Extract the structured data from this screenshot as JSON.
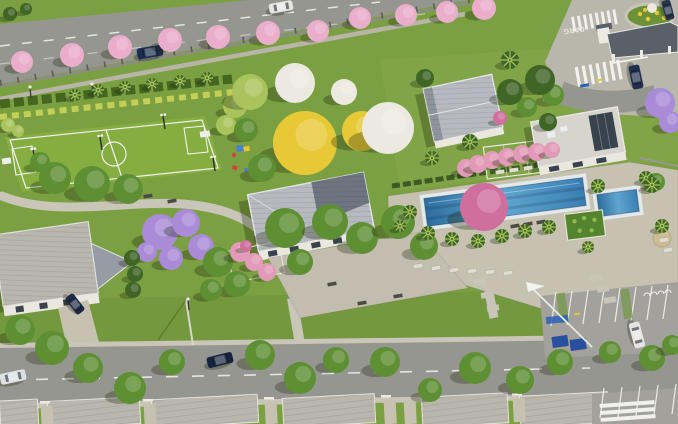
{
  "scene": {
    "description": "Aerial 3D architectural render of a gated residential community leisure area with soccer field, clubhouse, pool, playground, entrance gate and street of houses",
    "road_marking_text": "CARG",
    "palette": {
      "grass": "#7ba042",
      "grassDark": "#6c9136",
      "field": "#85ad3f",
      "asphalt": "#95968f",
      "paving": "#c6c1b0",
      "sidewalk": "#c9c5b8",
      "roofLight": "#b6bac0",
      "roofDark": "#6d7680",
      "roofHouse": "#b9b6ad",
      "wallWhite": "#eae7df",
      "water": "#3f7fae",
      "waterLight": "#6fb0d8",
      "coping": "#e3e8ea",
      "treeGreen": "#5f8f33",
      "treeDark": "#3f6527",
      "treeLight": "#a9c45c",
      "treePink": "#eaaecb",
      "treePurple": "#a98bd8",
      "treeYellow": "#e7c937",
      "treeWhite": "#ece9e0",
      "hedge": "#44661f",
      "shrubYellow": "#c3cf56",
      "flag": "#f2f2ef",
      "binBlue": "#2a4fa0",
      "pergolaPink": "#e29ab8",
      "bougainvillea": "#cf6f9e",
      "umbrellaTan": "#cdbd94",
      "flowersYellow": "#e4c93a",
      "shadow": "rgba(25,35,10,0.30)"
    },
    "trees": [
      {
        "x": 22,
        "y": 62,
        "r": 11,
        "t": "pink"
      },
      {
        "x": 72,
        "y": 55,
        "r": 12,
        "t": "pink"
      },
      {
        "x": 120,
        "y": 47,
        "r": 12,
        "t": "pink"
      },
      {
        "x": 170,
        "y": 40,
        "r": 12,
        "t": "pink"
      },
      {
        "x": 218,
        "y": 37,
        "r": 12,
        "t": "pink"
      },
      {
        "x": 268,
        "y": 33,
        "r": 12,
        "t": "pink"
      },
      {
        "x": 318,
        "y": 31,
        "r": 11,
        "t": "pink"
      },
      {
        "x": 360,
        "y": 18,
        "r": 11,
        "t": "pink"
      },
      {
        "x": 406,
        "y": 15,
        "r": 11,
        "t": "pink"
      },
      {
        "x": 447,
        "y": 12,
        "r": 11,
        "t": "pink"
      },
      {
        "x": 484,
        "y": 8,
        "r": 12,
        "t": "pink"
      },
      {
        "x": 160,
        "y": 232,
        "r": 18,
        "t": "purple"
      },
      {
        "x": 186,
        "y": 223,
        "r": 14,
        "t": "purple"
      },
      {
        "x": 201,
        "y": 247,
        "r": 13,
        "t": "purple"
      },
      {
        "x": 171,
        "y": 258,
        "r": 12,
        "t": "purple"
      },
      {
        "x": 147,
        "y": 252,
        "r": 10,
        "t": "purple"
      },
      {
        "x": 660,
        "y": 103,
        "r": 15,
        "t": "purple"
      },
      {
        "x": 670,
        "y": 122,
        "r": 11,
        "t": "purple"
      },
      {
        "x": 305,
        "y": 143,
        "r": 32,
        "t": "yellow"
      },
      {
        "x": 362,
        "y": 131,
        "r": 20,
        "t": "yellow"
      },
      {
        "x": 295,
        "y": 83,
        "r": 20,
        "t": "white"
      },
      {
        "x": 388,
        "y": 128,
        "r": 26,
        "t": "white"
      },
      {
        "x": 344,
        "y": 92,
        "r": 13,
        "t": "white"
      },
      {
        "x": 235,
        "y": 106,
        "r": 12,
        "t": "lgreen"
      },
      {
        "x": 250,
        "y": 92,
        "r": 18,
        "t": "lgreen"
      },
      {
        "x": 226,
        "y": 125,
        "r": 10,
        "t": "lgreen"
      },
      {
        "x": 8,
        "y": 125,
        "r": 7,
        "t": "lgreen"
      },
      {
        "x": 18,
        "y": 131,
        "r": 6,
        "t": "lgreen"
      },
      {
        "x": 55,
        "y": 178,
        "r": 16,
        "t": "green"
      },
      {
        "x": 92,
        "y": 184,
        "r": 18,
        "t": "green"
      },
      {
        "x": 128,
        "y": 189,
        "r": 15,
        "t": "green"
      },
      {
        "x": 40,
        "y": 162,
        "r": 10,
        "t": "green"
      },
      {
        "x": 262,
        "y": 168,
        "r": 14,
        "t": "green"
      },
      {
        "x": 246,
        "y": 130,
        "r": 12,
        "t": "green"
      },
      {
        "x": 285,
        "y": 228,
        "r": 20,
        "t": "green"
      },
      {
        "x": 330,
        "y": 222,
        "r": 18,
        "t": "green"
      },
      {
        "x": 362,
        "y": 238,
        "r": 16,
        "t": "green"
      },
      {
        "x": 300,
        "y": 262,
        "r": 13,
        "t": "green"
      },
      {
        "x": 218,
        "y": 262,
        "r": 15,
        "t": "green"
      },
      {
        "x": 237,
        "y": 284,
        "r": 13,
        "t": "green"
      },
      {
        "x": 211,
        "y": 290,
        "r": 11,
        "t": "green"
      },
      {
        "x": 398,
        "y": 222,
        "r": 17,
        "t": "green"
      },
      {
        "x": 424,
        "y": 246,
        "r": 14,
        "t": "green"
      },
      {
        "x": 553,
        "y": 95,
        "r": 11,
        "t": "green"
      },
      {
        "x": 527,
        "y": 107,
        "r": 10,
        "t": "green"
      },
      {
        "x": 656,
        "y": 182,
        "r": 9,
        "t": "green"
      },
      {
        "x": 20,
        "y": 330,
        "r": 15,
        "t": "green"
      },
      {
        "x": 52,
        "y": 348,
        "r": 17,
        "t": "green"
      },
      {
        "x": 88,
        "y": 368,
        "r": 15,
        "t": "green"
      },
      {
        "x": 130,
        "y": 388,
        "r": 16,
        "t": "green"
      },
      {
        "x": 172,
        "y": 362,
        "r": 13,
        "t": "green"
      },
      {
        "x": 260,
        "y": 355,
        "r": 15,
        "t": "green"
      },
      {
        "x": 300,
        "y": 378,
        "r": 16,
        "t": "green"
      },
      {
        "x": 336,
        "y": 360,
        "r": 13,
        "t": "green"
      },
      {
        "x": 385,
        "y": 362,
        "r": 15,
        "t": "green"
      },
      {
        "x": 430,
        "y": 390,
        "r": 12,
        "t": "green"
      },
      {
        "x": 475,
        "y": 368,
        "r": 16,
        "t": "green"
      },
      {
        "x": 520,
        "y": 380,
        "r": 14,
        "t": "green"
      },
      {
        "x": 560,
        "y": 362,
        "r": 13,
        "t": "green"
      },
      {
        "x": 610,
        "y": 352,
        "r": 11,
        "t": "green"
      },
      {
        "x": 652,
        "y": 358,
        "r": 13,
        "t": "green"
      },
      {
        "x": 672,
        "y": 345,
        "r": 10,
        "t": "green"
      },
      {
        "x": 540,
        "y": 80,
        "r": 15,
        "t": "dgreen"
      },
      {
        "x": 510,
        "y": 92,
        "r": 13,
        "t": "dgreen"
      },
      {
        "x": 548,
        "y": 122,
        "r": 9,
        "t": "dgreen"
      },
      {
        "x": 425,
        "y": 78,
        "r": 9,
        "t": "dgreen"
      },
      {
        "x": 132,
        "y": 258,
        "r": 8,
        "t": "dgreen"
      },
      {
        "x": 135,
        "y": 274,
        "r": 8,
        "t": "dgreen"
      },
      {
        "x": 133,
        "y": 290,
        "r": 8,
        "t": "dgreen"
      },
      {
        "x": 10,
        "y": 14,
        "r": 7,
        "t": "dgreen"
      },
      {
        "x": 26,
        "y": 9,
        "r": 6,
        "t": "dgreen"
      },
      {
        "x": 75,
        "y": 95,
        "r": 6,
        "t": "palm"
      },
      {
        "x": 98,
        "y": 90,
        "r": 6,
        "t": "palm"
      },
      {
        "x": 125,
        "y": 87,
        "r": 6,
        "t": "palm"
      },
      {
        "x": 152,
        "y": 84,
        "r": 6,
        "t": "palm"
      },
      {
        "x": 180,
        "y": 81,
        "r": 6,
        "t": "palm"
      },
      {
        "x": 207,
        "y": 78,
        "r": 6,
        "t": "palm"
      },
      {
        "x": 428,
        "y": 233,
        "r": 7,
        "t": "palm"
      },
      {
        "x": 452,
        "y": 239,
        "r": 7,
        "t": "palm"
      },
      {
        "x": 478,
        "y": 241,
        "r": 7,
        "t": "palm"
      },
      {
        "x": 502,
        "y": 236,
        "r": 7,
        "t": "palm"
      },
      {
        "x": 525,
        "y": 231,
        "r": 7,
        "t": "palm"
      },
      {
        "x": 549,
        "y": 227,
        "r": 7,
        "t": "palm"
      },
      {
        "x": 410,
        "y": 212,
        "r": 7,
        "t": "palm"
      },
      {
        "x": 400,
        "y": 226,
        "r": 6,
        "t": "palm"
      },
      {
        "x": 598,
        "y": 186,
        "r": 7,
        "t": "palm"
      },
      {
        "x": 646,
        "y": 178,
        "r": 7,
        "t": "palm"
      },
      {
        "x": 662,
        "y": 226,
        "r": 7,
        "t": "palm"
      },
      {
        "x": 588,
        "y": 247,
        "r": 6,
        "t": "palm"
      },
      {
        "x": 470,
        "y": 142,
        "r": 8,
        "t": "palm"
      },
      {
        "x": 510,
        "y": 60,
        "r": 9,
        "t": "palm"
      },
      {
        "x": 652,
        "y": 185,
        "r": 8,
        "t": "palm"
      },
      {
        "x": 432,
        "y": 158,
        "r": 7,
        "t": "palm"
      },
      {
        "x": 492,
        "y": 160,
        "r": 9,
        "t": "pinkP"
      },
      {
        "x": 507,
        "y": 157,
        "r": 9,
        "t": "pinkP"
      },
      {
        "x": 522,
        "y": 154,
        "r": 9,
        "t": "pinkP"
      },
      {
        "x": 537,
        "y": 152,
        "r": 9,
        "t": "pinkP"
      },
      {
        "x": 552,
        "y": 150,
        "r": 8,
        "t": "pinkP"
      },
      {
        "x": 466,
        "y": 168,
        "r": 9,
        "t": "pinkP"
      },
      {
        "x": 478,
        "y": 164,
        "r": 9,
        "t": "pinkP"
      },
      {
        "x": 240,
        "y": 252,
        "r": 10,
        "t": "pinkP"
      },
      {
        "x": 254,
        "y": 262,
        "r": 9,
        "t": "pinkP"
      },
      {
        "x": 267,
        "y": 272,
        "r": 9,
        "t": "pinkP"
      },
      {
        "x": 246,
        "y": 246,
        "r": 6,
        "t": "red"
      },
      {
        "x": 500,
        "y": 118,
        "r": 7,
        "t": "red"
      },
      {
        "x": 484,
        "y": 207,
        "r": 24,
        "t": "bgv"
      }
    ],
    "cars": [
      {
        "x": 150,
        "y": 52,
        "a": -10,
        "l": 26,
        "w": 11,
        "c": "#1c2f52",
        "n": "car-road-top-navy"
      },
      {
        "x": 281,
        "y": 7,
        "a": -10,
        "l": 24,
        "w": 10,
        "c": "#e6e6e3",
        "n": "car-road-top-white"
      },
      {
        "x": 636,
        "y": 77,
        "a": 78,
        "l": 24,
        "w": 11,
        "c": "#20304f",
        "n": "car-entrance-suv"
      },
      {
        "x": 668,
        "y": 10,
        "a": 75,
        "l": 20,
        "w": 9,
        "c": "#253550",
        "n": "car-entrance-top"
      },
      {
        "x": 220,
        "y": 360,
        "a": -14,
        "l": 26,
        "w": 11,
        "c": "#16243f",
        "n": "car-street-navy"
      },
      {
        "x": 13,
        "y": 377,
        "a": -12,
        "l": 26,
        "w": 11,
        "c": "#dde1e4",
        "n": "car-street-white"
      },
      {
        "x": 637,
        "y": 335,
        "a": 75,
        "l": 26,
        "w": 11,
        "c": "#e4e4e1",
        "n": "car-parking-white"
      },
      {
        "x": 75,
        "y": 304,
        "a": 52,
        "l": 21,
        "w": 10,
        "c": "#1c2b45",
        "n": "car-driveway-navy"
      }
    ],
    "props": {
      "benches": [
        [
          148,
          196
        ],
        [
          172,
          201
        ],
        [
          332,
          284
        ],
        [
          398,
          296
        ],
        [
          362,
          303
        ],
        [
          515,
          226
        ],
        [
          528,
          224
        ],
        [
          541,
          222
        ]
      ],
      "loungers": [
        [
          418,
          266
        ],
        [
          436,
          268
        ],
        [
          454,
          270
        ],
        [
          472,
          271
        ],
        [
          490,
          272
        ],
        [
          508,
          273
        ],
        [
          664,
          240
        ],
        [
          668,
          250
        ],
        [
          500,
          172
        ],
        [
          514,
          170
        ],
        [
          528,
          168
        ]
      ],
      "floodlights": [
        [
          33,
          150
        ],
        [
          100,
          137
        ],
        [
          163,
          116
        ],
        [
          213,
          158
        ]
      ],
      "lamps": [
        [
          30,
          88
        ],
        [
          92,
          85
        ],
        [
          188,
          300
        ]
      ],
      "stones": [
        [
          480,
          282
        ],
        [
          487,
          295
        ],
        [
          493,
          308
        ],
        [
          596,
          278
        ],
        [
          603,
          289
        ],
        [
          610,
          300
        ]
      ]
    }
  }
}
